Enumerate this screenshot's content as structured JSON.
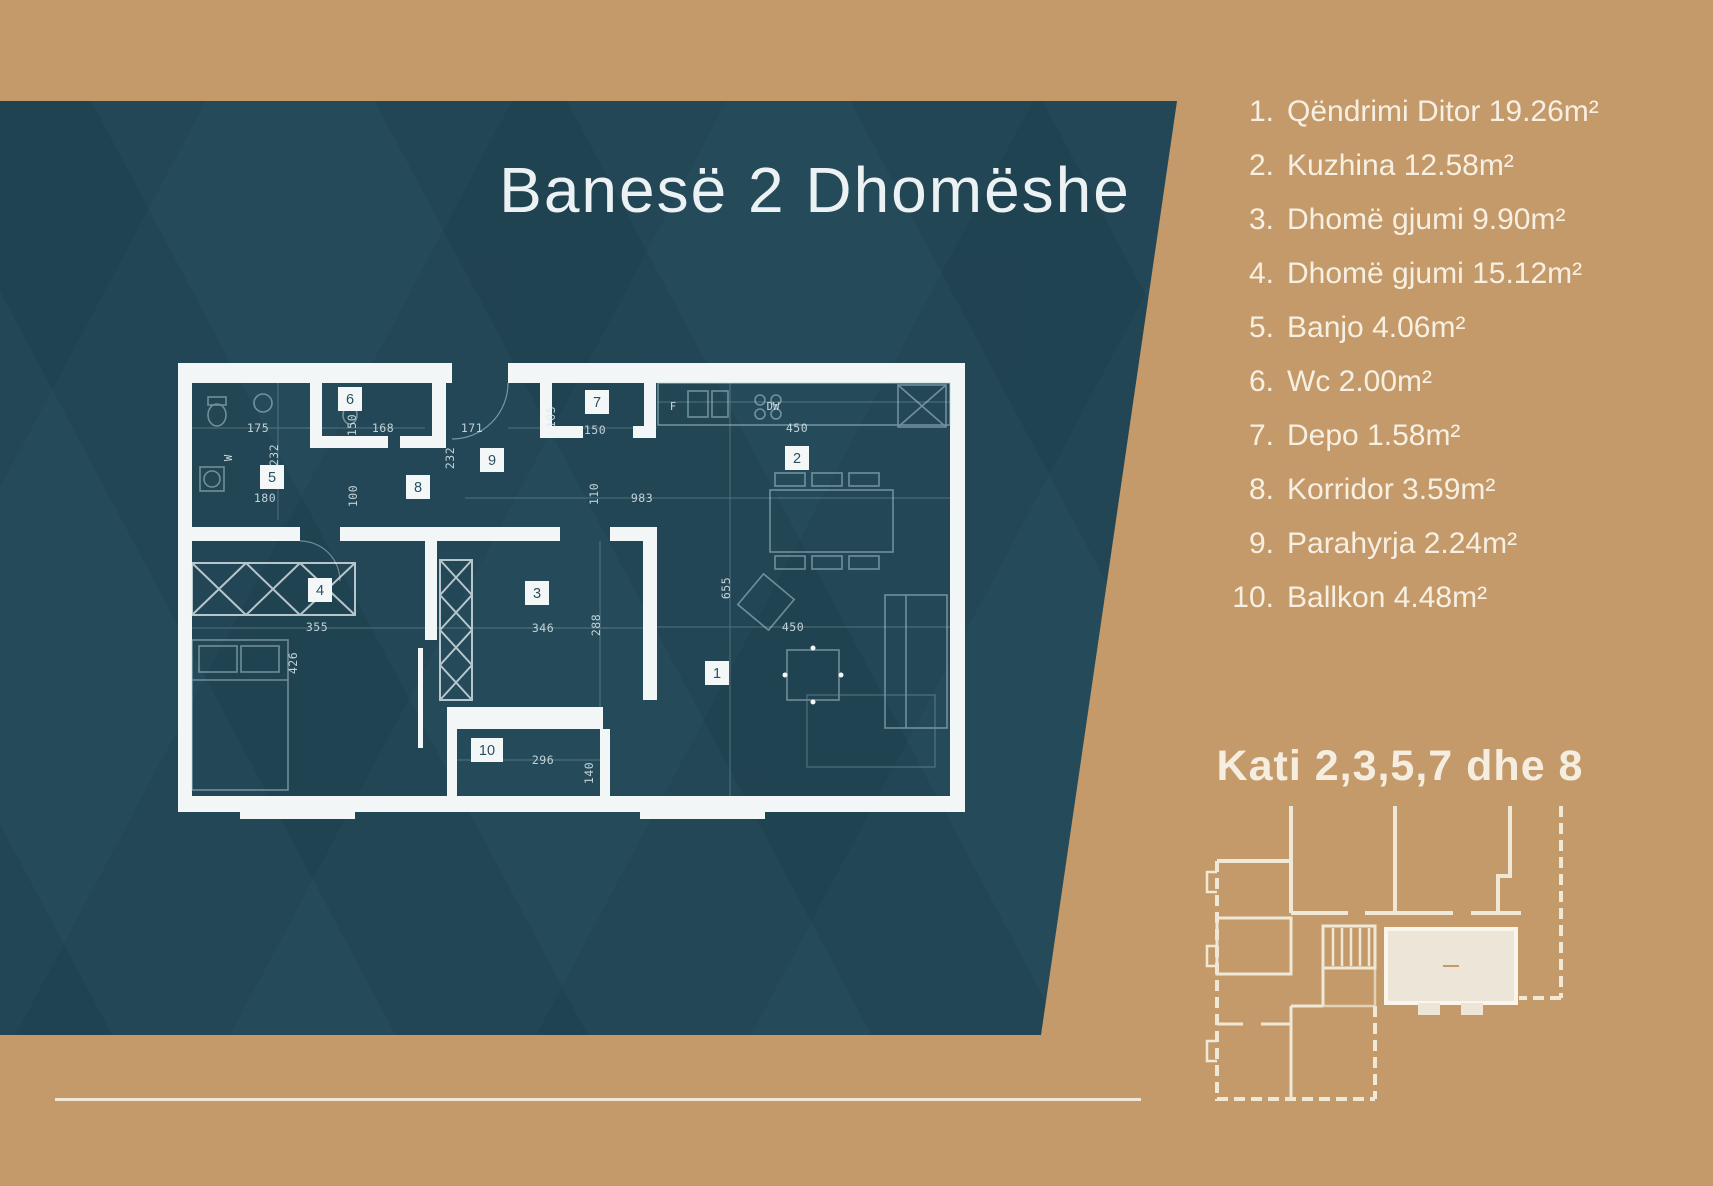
{
  "title": "Banesë 2 Dhomëshe",
  "floor_heading": "Kati 2,3,5,7 dhe 8",
  "room_list": {
    "items": [
      {
        "num": "1.",
        "text": "Qëndrimi Ditor 19.26m²"
      },
      {
        "num": "2.",
        "text": "Kuzhina 12.58m²"
      },
      {
        "num": "3.",
        "text": "Dhomë gjumi 9.90m²"
      },
      {
        "num": "4.",
        "text": "Dhomë gjumi 15.12m²"
      },
      {
        "num": "5.",
        "text": "Banjo 4.06m²"
      },
      {
        "num": "6.",
        "text": "Wc 2.00m²"
      },
      {
        "num": "7.",
        "text": "Depo 1.58m²"
      },
      {
        "num": "8.",
        "text": "Korridor 3.59m²"
      },
      {
        "num": "9.",
        "text": "Parahyrja 2.24m²"
      },
      {
        "num": "10.",
        "text": "Ballkon 4.48m²"
      }
    ]
  },
  "floor_plan": {
    "badges": [
      "1",
      "2",
      "3",
      "4",
      "5",
      "6",
      "7",
      "8",
      "9",
      "10"
    ],
    "dims": {
      "d175": "175",
      "d232a": "232",
      "d180": "180",
      "d168": "168",
      "d150a": "150",
      "d171": "171",
      "d232b": "232",
      "d105": "105",
      "d150b": "150",
      "d450a": "450",
      "d983": "983",
      "d110": "110",
      "d100": "100",
      "d655": "655",
      "d450b": "450",
      "d355": "355",
      "d426": "426",
      "d346": "346",
      "d288": "288",
      "d296": "296",
      "d140": "140"
    },
    "labels": {
      "dishwasher": "DW",
      "fridge": "F",
      "washer": "W"
    }
  },
  "colors": {
    "tan": "#C49A6A",
    "teal": "#254B5A",
    "cream": "#F5EEE0",
    "wall_white": "#F2F6F7",
    "unit_fill": "#EDE6D8"
  }
}
